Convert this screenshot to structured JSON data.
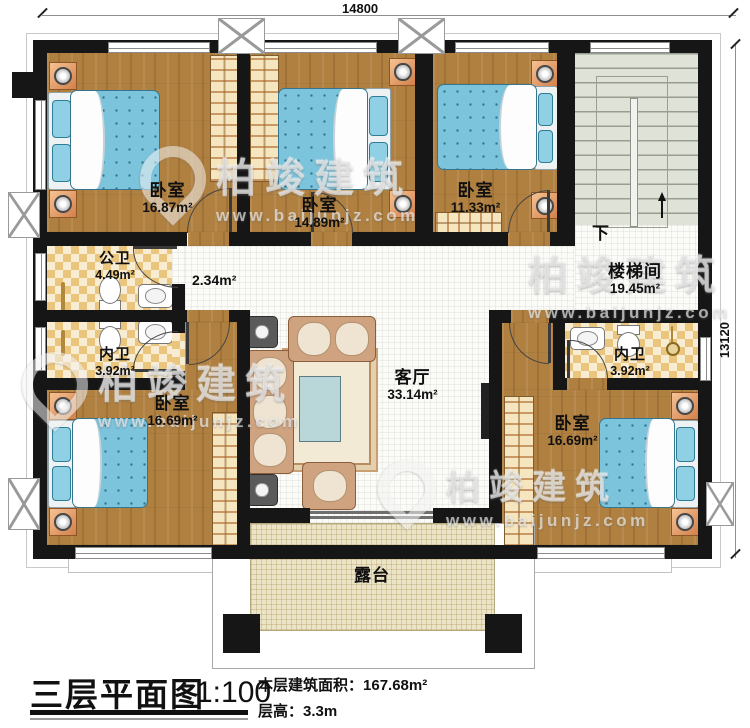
{
  "dimensions": {
    "width_mm": "14800",
    "height_mm": "13120"
  },
  "rooms": {
    "bedroom_top_left": {
      "name": "卧室",
      "area": "16.87m²"
    },
    "bedroom_top_middle": {
      "name": "卧室",
      "area": "14.89m²"
    },
    "bedroom_top_right": {
      "name": "卧室",
      "area": "11.33m²"
    },
    "stairwell": {
      "name": "楼梯间",
      "area": "19.45m²",
      "down_label": "下"
    },
    "public_bathroom": {
      "name": "公卫",
      "area": "4.49m²"
    },
    "hallway": {
      "area": "2.34m²"
    },
    "ensuite_bathroom_left": {
      "name": "内卫",
      "area": "3.92m²"
    },
    "ensuite_bathroom_right": {
      "name": "内卫",
      "area": "3.92m²"
    },
    "bedroom_bottom_left": {
      "name": "卧室",
      "area": "16.69m²"
    },
    "bedroom_bottom_right": {
      "name": "卧室",
      "area": "16.69m²"
    },
    "living_room": {
      "name": "客厅",
      "area": "33.14m²"
    },
    "terrace": {
      "name": "露台"
    }
  },
  "title_block": {
    "title": "三层平面图",
    "scale": "1:100",
    "floor_area_label": "本层建筑面积：",
    "floor_area_value": "167.68m²",
    "floor_height_label": "层高：",
    "floor_height_value": "3.3m"
  },
  "watermark": {
    "brand": "柏竣建筑",
    "website": "www.baijunjz.com"
  },
  "colors": {
    "wall": "#161616",
    "wood_floor": "#b08040",
    "bathroom_tile": "#eac57e",
    "bed": "#7cc4dc",
    "terrace": "#ece4c6",
    "accent_nightstand": "#e09a63"
  }
}
